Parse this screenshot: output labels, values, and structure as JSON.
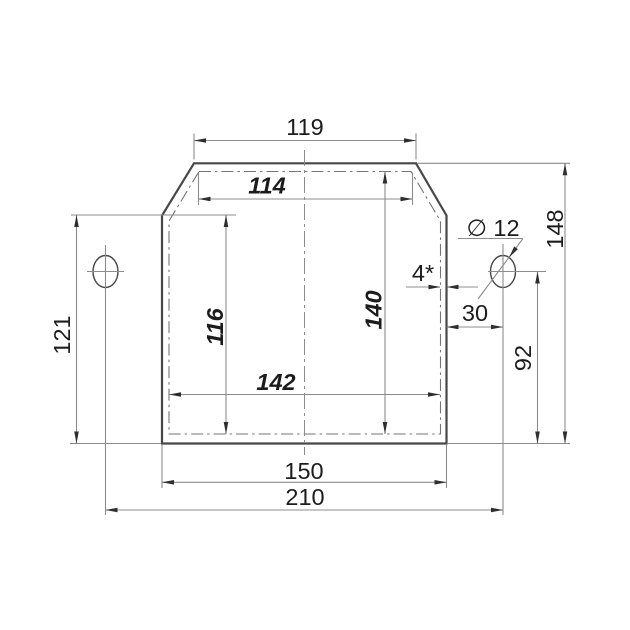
{
  "drawing": {
    "background": "#ffffff",
    "outline_color": "#474747",
    "thin_line_color": "#8c8c8c",
    "text_color": "#1c1c1c",
    "dimensions": {
      "outer_top_width": "119",
      "inner_top_width": "114",
      "left_height": "121",
      "inner_left_height": "116",
      "inner_right_height": "140",
      "inner_bottom_width": "142",
      "bottom_width": "150",
      "overall_width": "210",
      "overall_height": "148",
      "hole_to_wall": "30",
      "hole_to_bottom": "92",
      "wall_thickness": "4*",
      "hole_diameter": "∅ 12"
    }
  }
}
